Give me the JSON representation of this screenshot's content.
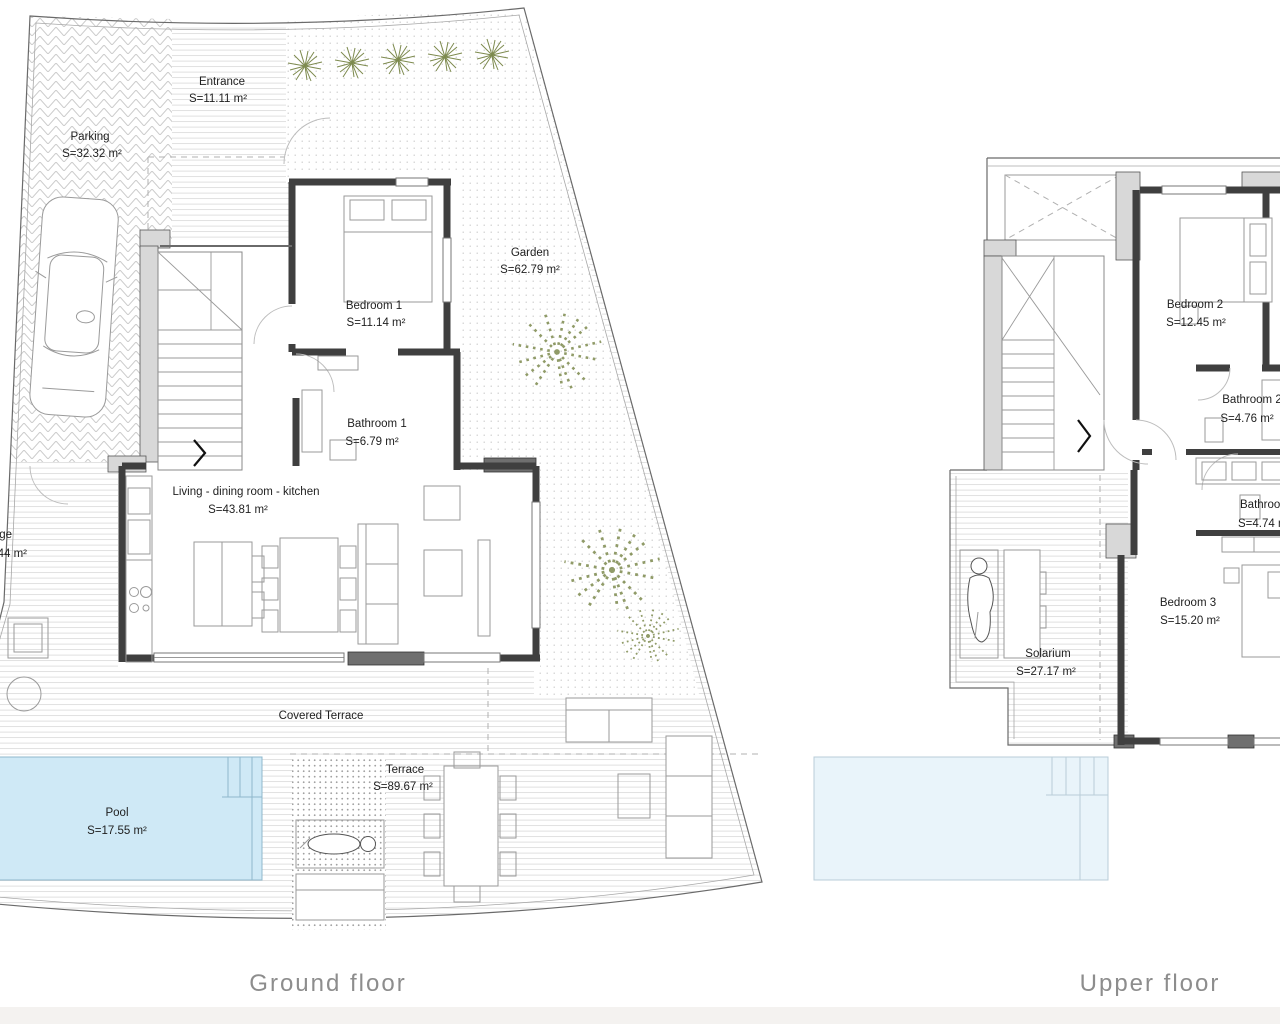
{
  "colors": {
    "pool": "#cfe9f6",
    "pool_upper": "#e9f4fa",
    "plant": "#7d8a4e",
    "wall": "#3f3f3f",
    "caption": "#8d8d8d"
  },
  "ground": {
    "caption": "Ground floor",
    "parking": {
      "name": "Parking",
      "area": "S=32.32 m²"
    },
    "entrance": {
      "name": "Entrance",
      "area": "S=11.11 m²"
    },
    "garden": {
      "name": "Garden",
      "area": "S=62.79 m²"
    },
    "bedroom1": {
      "name": "Bedroom 1",
      "area": "S=11.14 m²"
    },
    "bathroom1": {
      "name": "Bathroom 1",
      "area": "S=6.79 m²"
    },
    "living": {
      "name": "Living - dining  room - kitchen",
      "area": "S=43.81 m²"
    },
    "covered_terrace": {
      "name": "Covered Terrace"
    },
    "pool": {
      "name": "Pool",
      "area": "S=17.55 m²"
    },
    "terrace": {
      "name": "Terrace",
      "area": "S=89.67 m²"
    },
    "cut_label": {
      "name": "ge",
      "area": "44 m²"
    }
  },
  "upper": {
    "caption": "Upper floor",
    "bedroom2": {
      "name": "Bedroom 2",
      "area": "S=12.45 m²"
    },
    "bathroom2": {
      "name": "Bathroom 2",
      "area": "S=4.76 m²"
    },
    "bathroom3": {
      "name": "Bathroom",
      "area": "S=4.74 m"
    },
    "bedroom3": {
      "name": "Bedroom 3",
      "area": "S=15.20 m²"
    },
    "solarium": {
      "name": "Solarium",
      "area": "S=27.17 m²"
    }
  }
}
